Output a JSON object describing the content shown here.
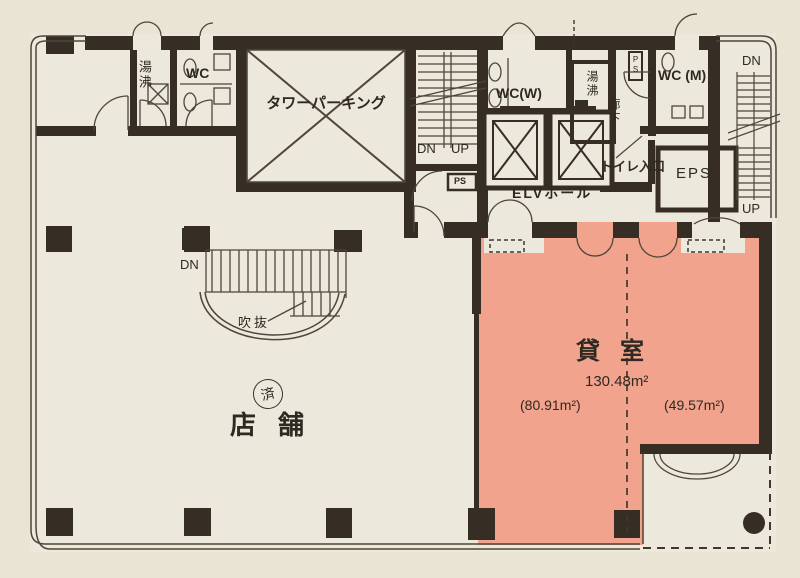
{
  "document": {
    "type": "building-floor-plan"
  },
  "colors": {
    "paper": "#e9e4d4",
    "floor": "#ece8db",
    "wall": "#362e24",
    "line": "#4d4639",
    "rental_fill": "#f1a38d",
    "text": "#2e2921"
  },
  "labels": {
    "yuwakashi_nw": "湯沸",
    "wc_nw": "WC",
    "tower_parking": "タワーパーキング",
    "stair_center_dn": "DN",
    "stair_center_up": "UP",
    "ps_box": "PS",
    "wc_w": "WC(W)",
    "yuwakashi_mid": "湯沸",
    "rouka": "廊下",
    "ps_small": "PS",
    "wc_m": "WC (M)",
    "stair_right_dn": "DN",
    "stair_right_up": "UP",
    "elv_hall": "ELVホール",
    "toilet_entrance": "トイレ入口",
    "eps": "EPS",
    "stair_store_dn": "DN",
    "fukinuke": "吹抜",
    "stamp": "済",
    "store": "店舗",
    "rental_room": "貸室",
    "rental_area_total": "130.48m²",
    "rental_area_left": "(80.91m²)",
    "rental_area_right": "(49.57m²)"
  }
}
